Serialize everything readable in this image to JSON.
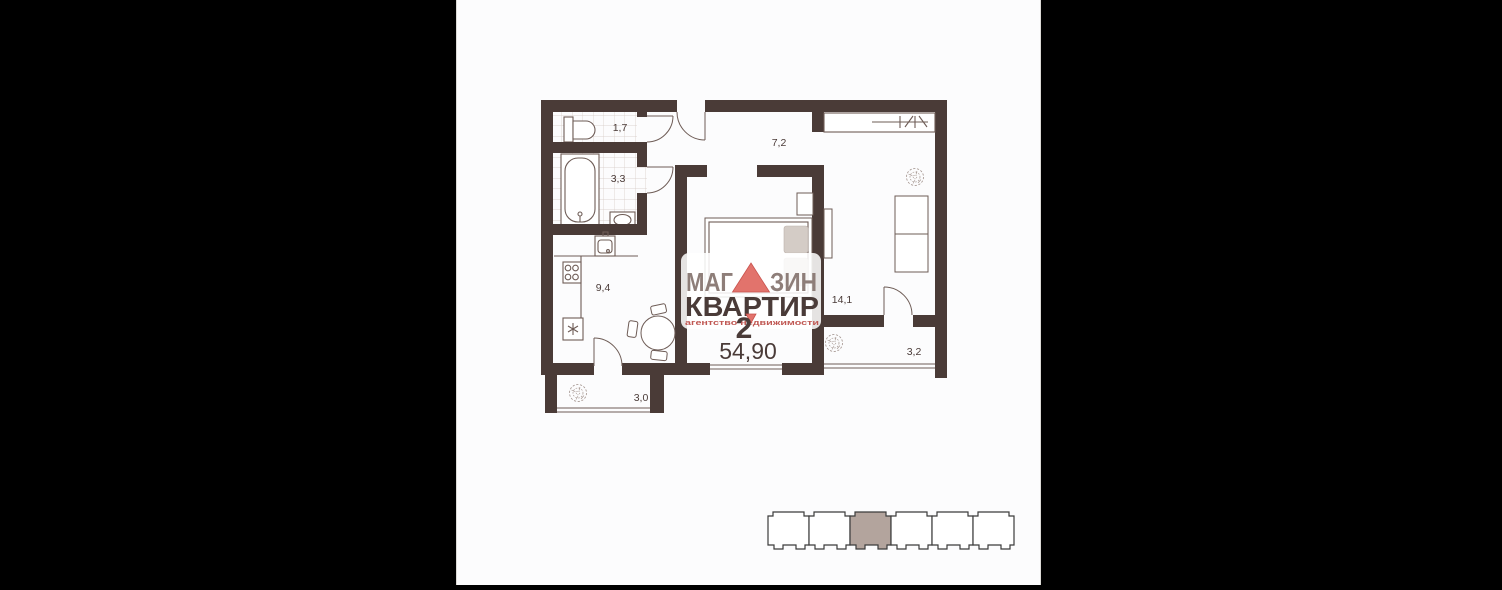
{
  "window": {
    "background": "#000000",
    "canvas_bg": "#fcfcfd"
  },
  "colors": {
    "wall": "#4a3b37",
    "line": "#6e5c56",
    "tile": "#d4c8c2",
    "pillow": "#d4ccc6",
    "label": "#4a3b38",
    "logo_gray": "#8e7e79",
    "logo_dark": "#4a3b38",
    "logo_red": "#e2736c",
    "tagline_red": "#c05853",
    "indicator_outline": "#3b3b3b",
    "indicator_highlight": "#b3a49d"
  },
  "floor_plan": {
    "rooms": [
      {
        "name": "wc",
        "area_label": "1,7"
      },
      {
        "name": "bathroom",
        "area_label": "3,3"
      },
      {
        "name": "hallway",
        "area_label": "7,2"
      },
      {
        "name": "kitchen",
        "area_label": "9,4"
      },
      {
        "name": "living-room",
        "area_label": "14,1"
      },
      {
        "name": "balcony-right",
        "area_label": "3,2"
      },
      {
        "name": "balcony-left",
        "area_label": "3,0"
      }
    ],
    "apartment": {
      "rooms_count": "2",
      "total_area": "54,90"
    }
  },
  "logo": {
    "word1_part1": "МАГ",
    "word1_part2": "ЗИН",
    "word2": "КВАРТИР",
    "tagline": "агентство недвижимости"
  },
  "building_indicator": {
    "sections": 6,
    "highlighted_index": 2
  }
}
